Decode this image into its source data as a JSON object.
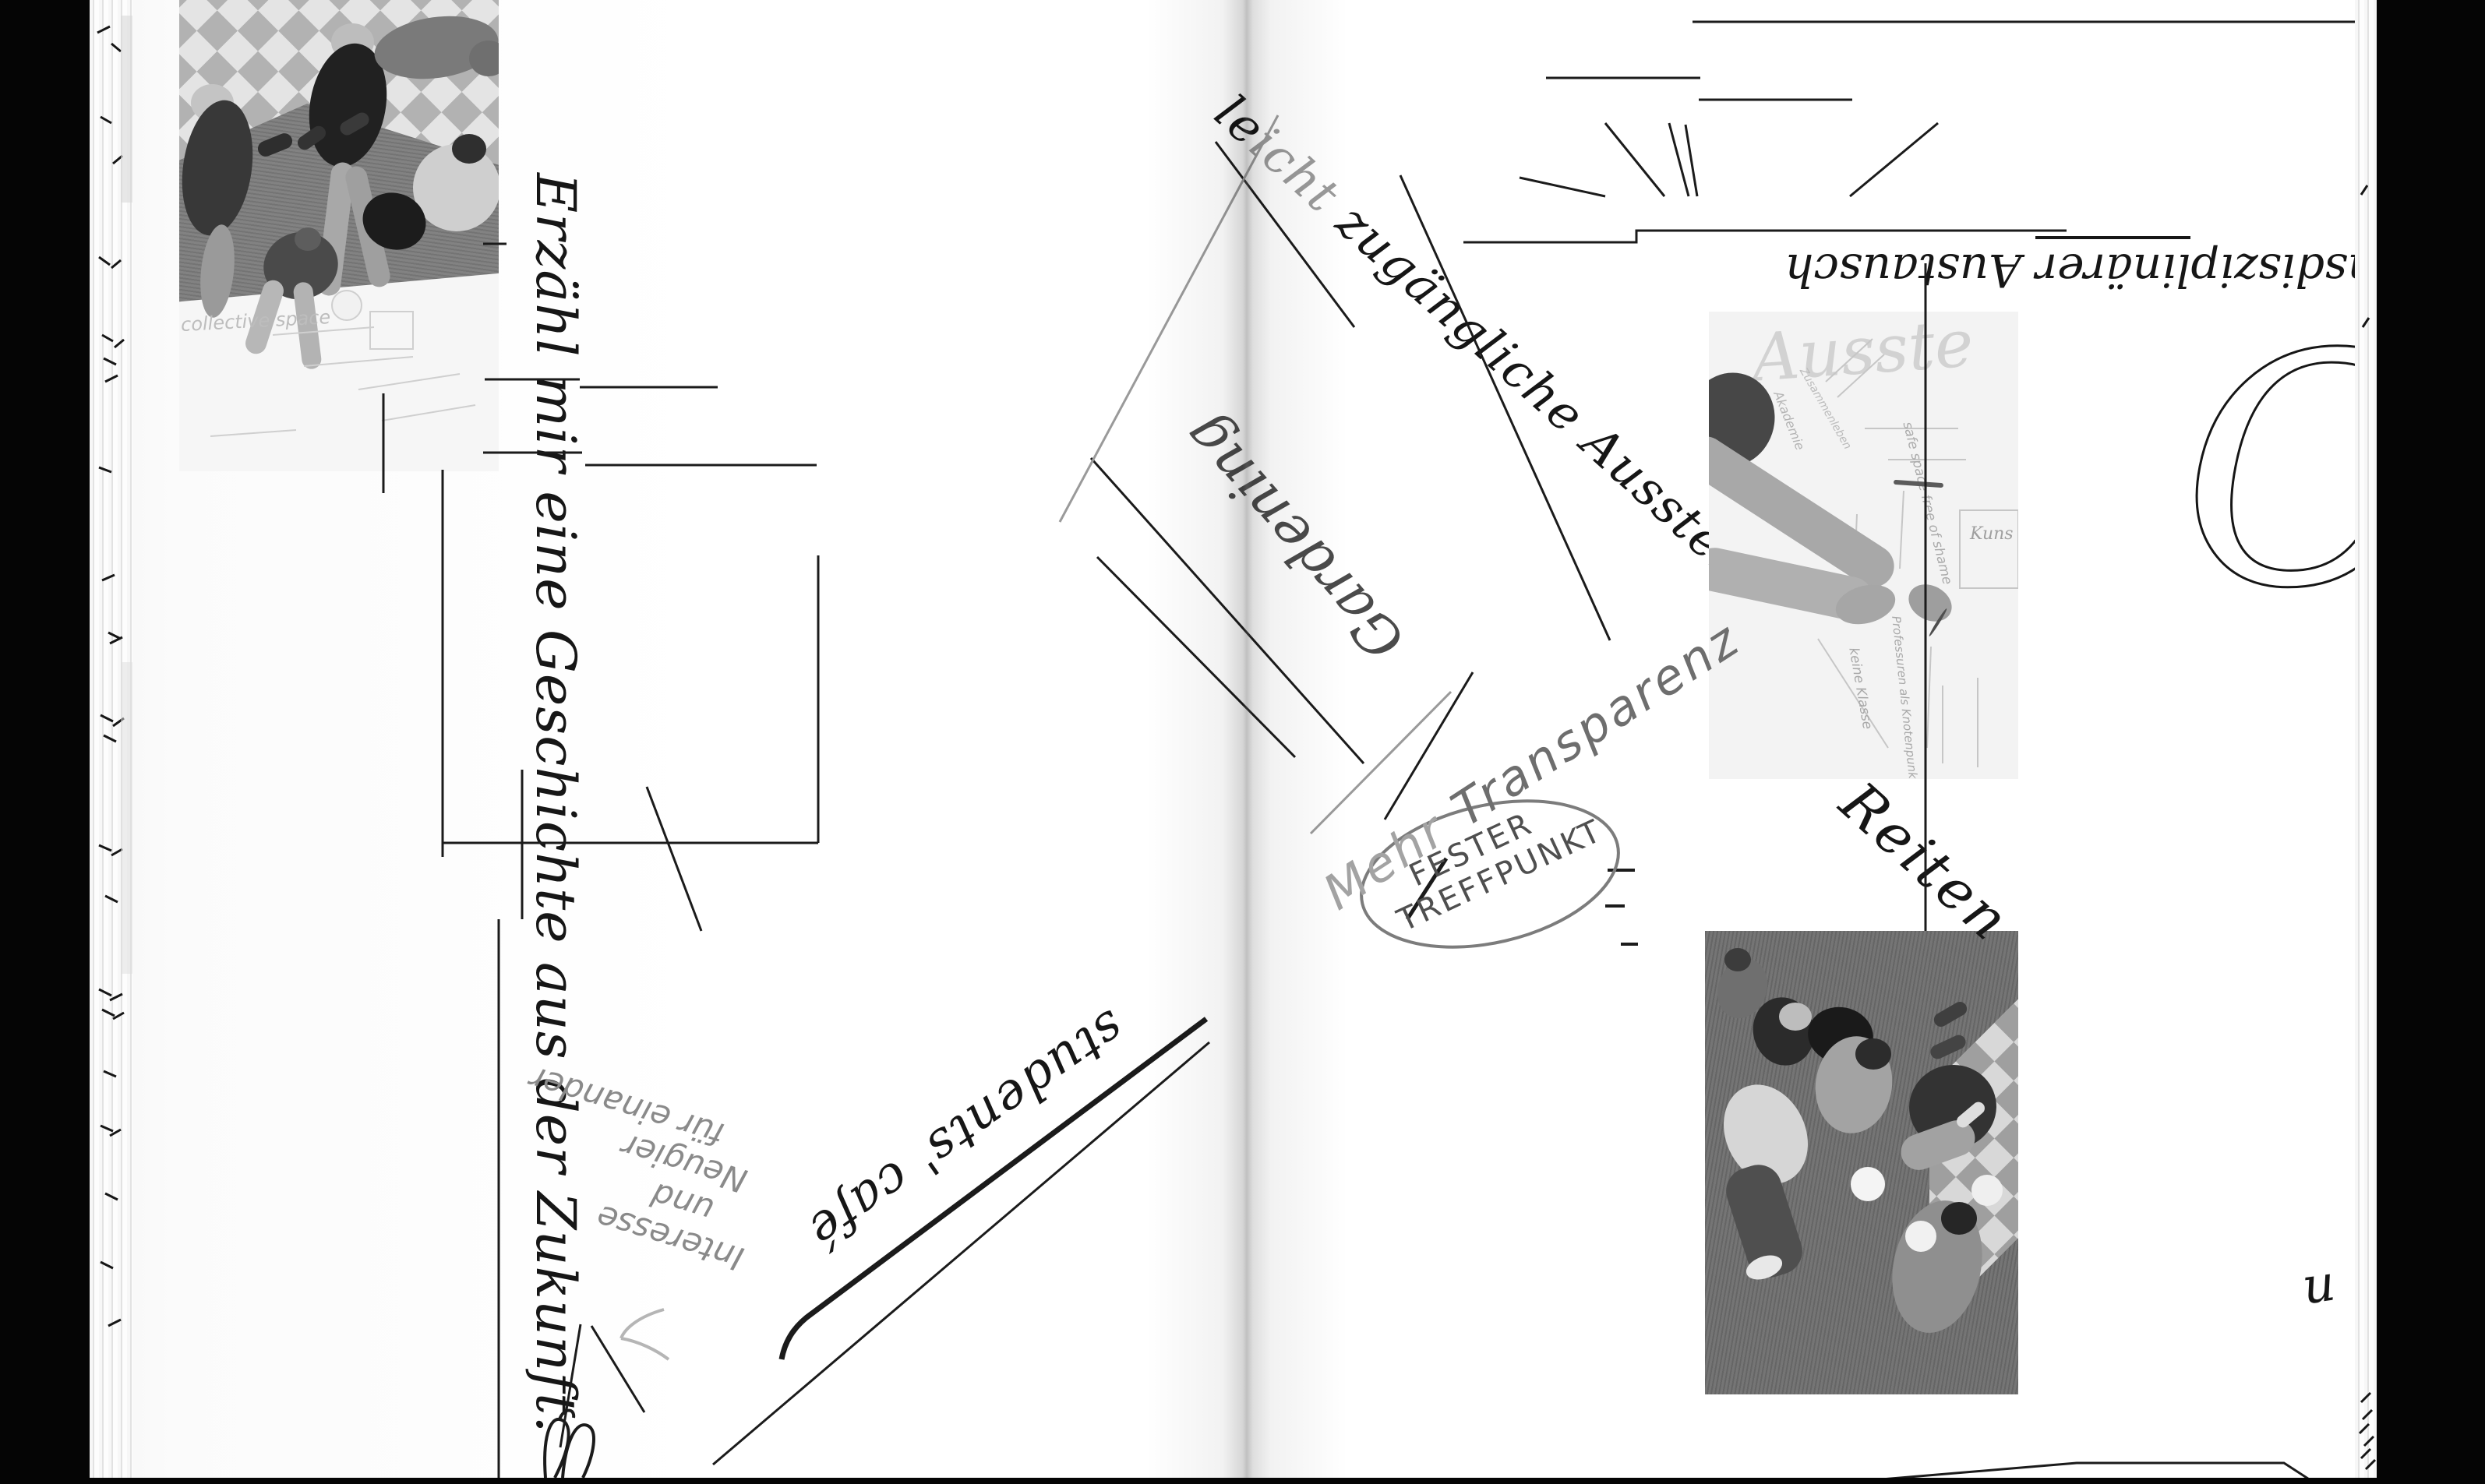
{
  "spread": {
    "left_page": {
      "title": "Erzähl mir eine Geschichte aus der Zukunft.",
      "notes": {
        "interesse": {
          "line1": "Interesse",
          "line2": "und",
          "line3": "Neugier",
          "line4": "für einander"
        },
        "cafe": "students' café"
      },
      "photo_overhead": {
        "paper_caption": "collective space"
      }
    },
    "gutter_note": {
      "gardening": "Gardening"
    },
    "right_page": {
      "exhibition": {
        "lead": "le",
        "light": "icht",
        "tail": " zugängliche Ausstellu"
      },
      "austausch": {
        "pre": "nsdiszip",
        "underlined": "linärer",
        "post": " Austausch"
      },
      "transparenz": {
        "word1": "Mehr ",
        "word2": "Transparenz"
      },
      "treffpunkt": {
        "line1": "FESTER",
        "line2": "TREFFPUNKT"
      },
      "reiten": "Reiten",
      "edge_initial": "Ca",
      "edge_fragment": "u",
      "photo_paper": {
        "headline": "Ausste",
        "note1": "safe space free of shame",
        "note2": "Akademie",
        "note3": "Zusammenleben",
        "note4": "keine Klasse",
        "note5": "Professuren als Knotenpunkt",
        "note6": "Kuns"
      }
    },
    "colors": {
      "ink": "#161616",
      "pencil": "#8a8a8a",
      "page": "#fbfbfb",
      "background": "#000000"
    }
  }
}
